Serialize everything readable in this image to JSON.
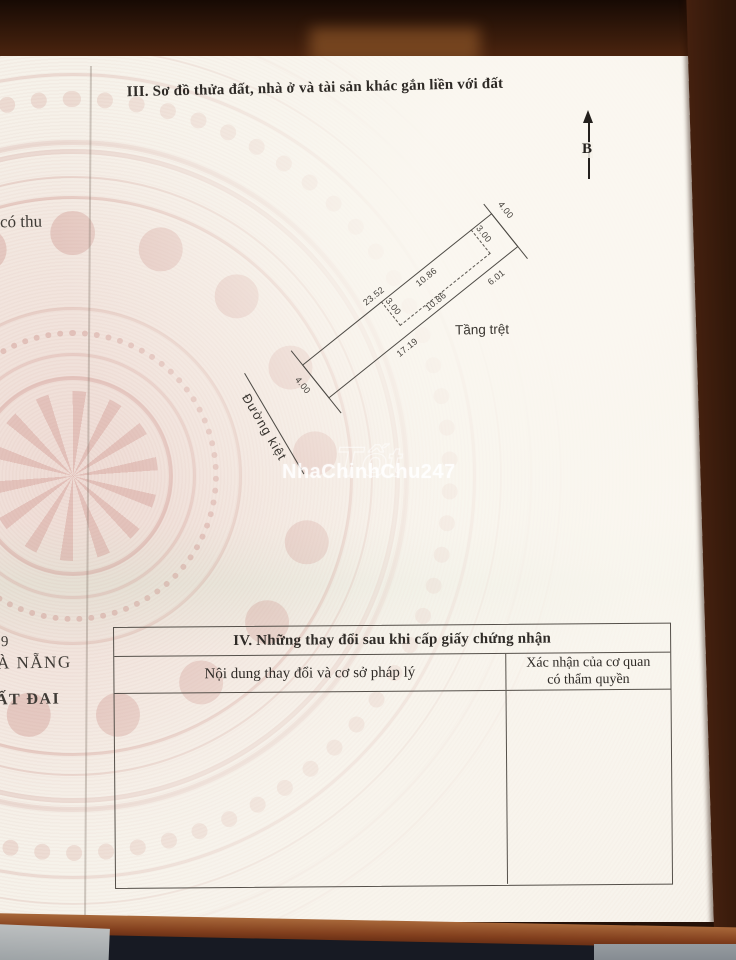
{
  "page": {
    "section3_title": "III. Sơ đồ thửa đất, nhà ở và tài sản khác gắn liền với đất",
    "compass_label": "B",
    "watermark": "NhaChinhChu247",
    "watermark_ghost": "Tốt"
  },
  "diagram": {
    "dims": {
      "top_edge": "23.52",
      "house_top": "10.86",
      "house_bottom": "10.86",
      "house_width_right": "3.00",
      "house_width_left": "3.00",
      "right_end": "4.00",
      "left_end": "4.00",
      "bottom_right_segment": "6.01",
      "bottom_left_segment": "17.19"
    },
    "labels": {
      "ground_floor": "Tầng trệt",
      "alley": "Đường kiệt"
    }
  },
  "edge_texts": {
    "fee_fragment": "có thu",
    "digit_fragment": "9",
    "city_fragment": "À NẴNG",
    "land_fragment": "ẤT ĐAI"
  },
  "section4": {
    "title": "IV. Những thay đổi sau khi cấp giấy chứng nhận",
    "col1_header": "Nội dung thay đổi và cơ sở pháp lý",
    "col2_header": "Xác nhận của cơ quan có thẩm quyền"
  },
  "colors": {
    "paper": "#f6f2ea",
    "pattern_pink": "#d9a49c",
    "wood_dark": "#3a1c0e",
    "wood_strip": "#8a4a26",
    "line_ink": "#4d4a45"
  }
}
